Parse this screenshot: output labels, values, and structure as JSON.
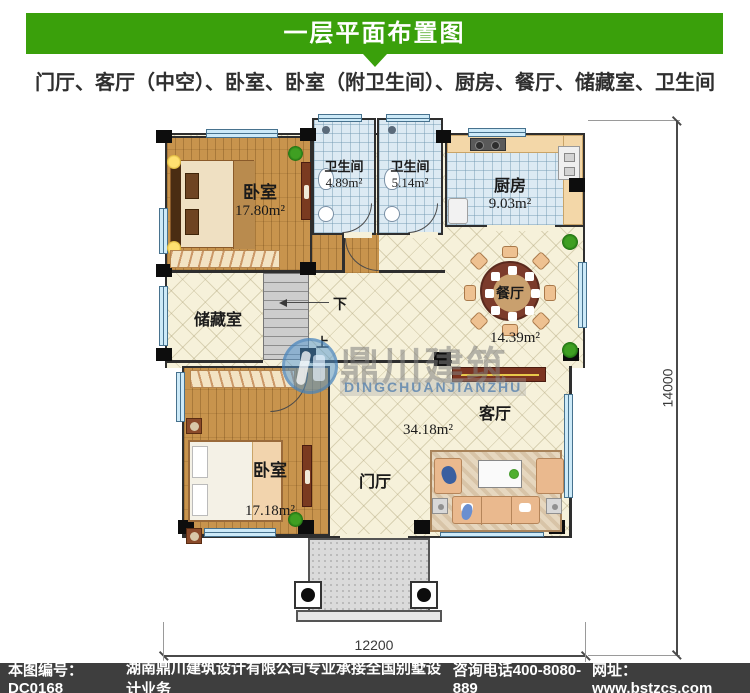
{
  "header": {
    "title": "一层平面布置图",
    "subtitle": "门厅、客厅（中空）、卧室、卧室（附卫生间）、厨房、餐厅、储藏室、卫生间"
  },
  "plan": {
    "rooms": {
      "bedroom_tl": {
        "name": "卧室",
        "area": "17.80m²"
      },
      "bath_left": {
        "name": "卫生间",
        "area": "4.89m²"
      },
      "bath_right": {
        "name": "卫生间",
        "area": "5.14m²"
      },
      "kitchen": {
        "name": "厨房",
        "area": "9.03m²"
      },
      "dining": {
        "name": "餐厅",
        "area": "14.39m²"
      },
      "storage": {
        "name": "储藏室"
      },
      "bedroom_bl": {
        "name": "卧室",
        "area": "17.18m²"
      },
      "living": {
        "name": "客厅",
        "area": "34.18m²"
      },
      "foyer": {
        "name": "门厅"
      }
    },
    "stairs": {
      "down": "下",
      "up": "上"
    },
    "dimensions": {
      "width": "12200",
      "height": "14000"
    }
  },
  "watermark": {
    "cn": "鼎川建筑",
    "en": "DINGCHUANJIANZHU"
  },
  "footer": {
    "code": "本图编号：DC0168",
    "company": "湖南鼎川建筑设计有限公司专业承接全国别墅设计业务",
    "phone": "咨询电话400-8080-889",
    "website": "网址：www.bstzcs.com"
  },
  "colors": {
    "accent_green": "#3aa00b",
    "footer_bg": "#3e3e3e",
    "wood": "#c8944d",
    "tile_blue": "#dceaf3",
    "floor_cream": "#f6f1da"
  }
}
